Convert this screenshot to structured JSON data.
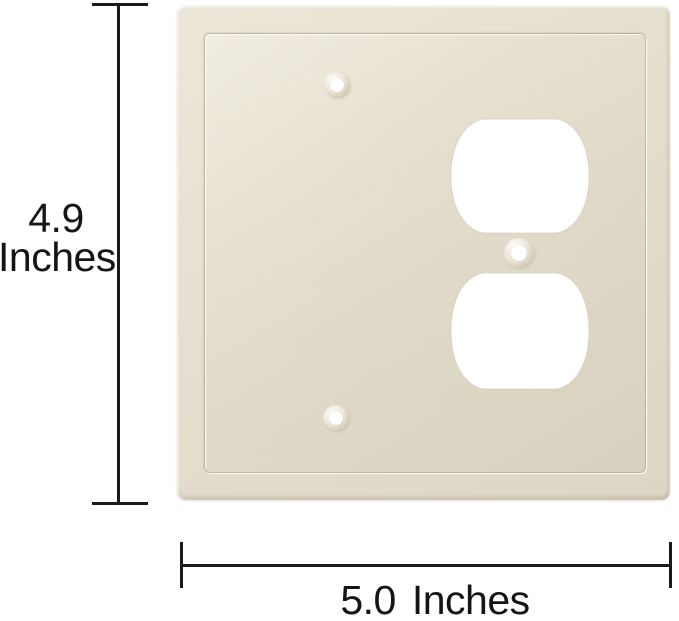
{
  "vertical_dimension": {
    "value": "4.9",
    "unit": "Inches"
  },
  "horizontal_dimension": {
    "value": "5.0",
    "unit": "Inches"
  },
  "plate": {
    "gang_count": 2,
    "colors": {
      "plate_base": "#e3ddcc",
      "plate_highlight": "#efeadb",
      "plate_shadow": "#d6cfbc",
      "groove_line": "#a79b7c",
      "cutout": "#ffffff",
      "dimension_line": "#1b1b1b",
      "background": "#ffffff"
    }
  }
}
